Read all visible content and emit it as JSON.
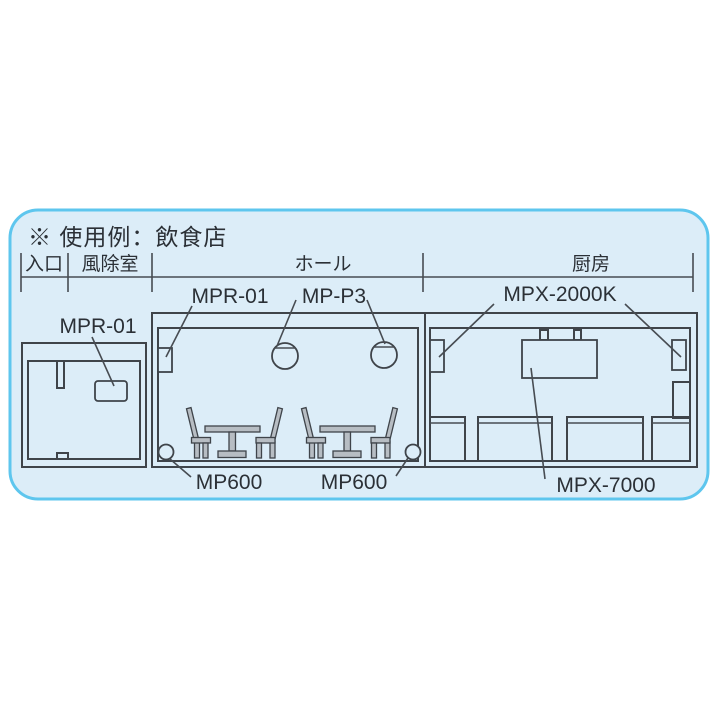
{
  "panel": {
    "title": "※ 使用例：飲食店",
    "bg": "#dcedf8",
    "border_color": "#5ec6ee",
    "line_color": "#3f444a"
  },
  "dimension": {
    "sections": [
      {
        "label": "入口"
      },
      {
        "label": "風除室"
      },
      {
        "label": "ホール"
      },
      {
        "label": "厨房"
      }
    ]
  },
  "devices": {
    "entry_unit": "MPR-01",
    "hall_wall_unit": "MPR-01",
    "pendant_speakers": "MP-P3",
    "kitchen_wall_units": "MPX-2000K",
    "kitchen_main_unit": "MPX-7000",
    "floor_speaker_left": "MP600",
    "floor_speaker_right": "MP600"
  }
}
